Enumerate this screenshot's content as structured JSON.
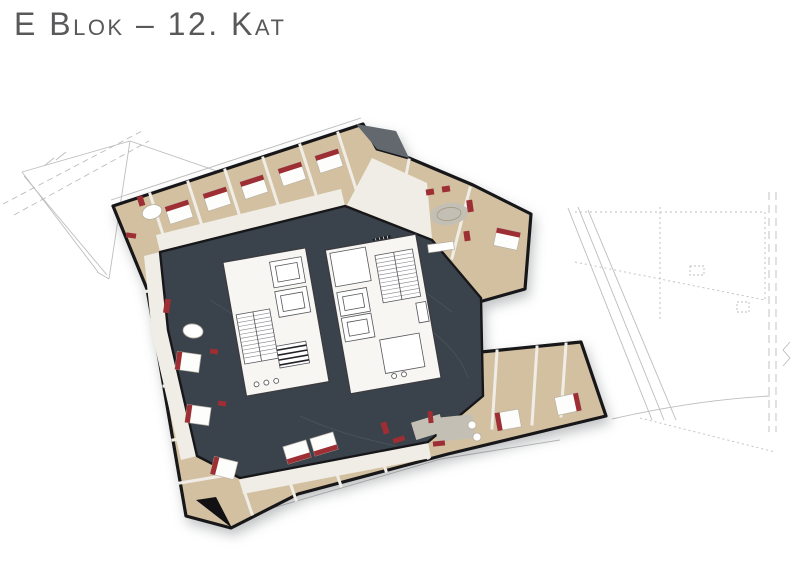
{
  "page": {
    "title": "E Blok – 12. Kat"
  },
  "plan": {
    "colors": {
      "background": "#ffffff",
      "title_color": "#59595c",
      "corridor": "#3a424b",
      "floor_wood": "#d3c0a1",
      "wall_dark": "#17171a",
      "wall_light": "#f0ede7",
      "core_white": "#f7f6f3",
      "accent_red": "#9c2e34",
      "rug_gray": "#c4bfb4",
      "wireframe": "#bdbdbd",
      "roof_gray": "#62686d"
    }
  }
}
